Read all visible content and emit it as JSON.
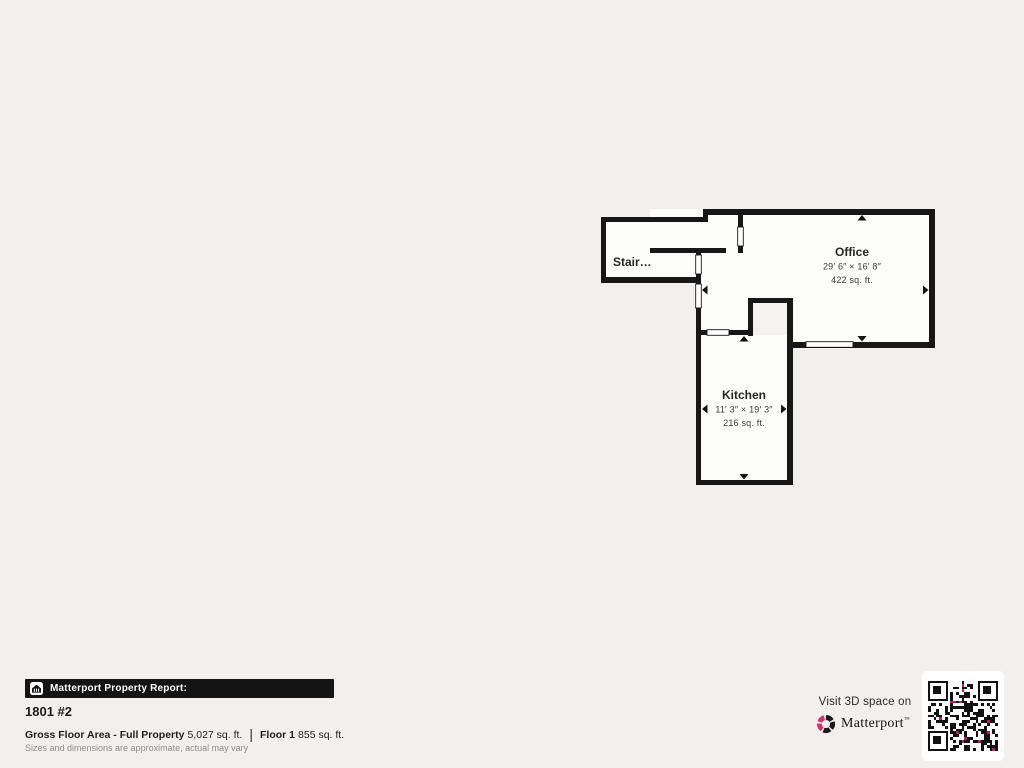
{
  "colors": {
    "page_background": "#f1f0ee",
    "wall": "#171717",
    "room_fill": "#fcfcfb",
    "report_bar_background": "#141414",
    "brand_pink": "#d2356d",
    "qr_accent": "#b22560"
  },
  "floorplan": {
    "rooms": [
      {
        "name": "Stair…"
      },
      {
        "name": "Office",
        "dimensions": "29′ 6″ × 16′ 8″",
        "area": "422 sq. ft."
      },
      {
        "name": "Kitchen",
        "dimensions": "11′ 3″ × 19′ 3″",
        "area": "216 sq. ft."
      }
    ]
  },
  "report": {
    "bar_title": "Matterport Property Report:",
    "unit_title": "1801 #2",
    "gross_label": "Gross Floor Area - Full Property",
    "gross_value": "5,027 sq. ft.",
    "divider": "|",
    "floor_label": "Floor 1",
    "floor_value": "855 sq. ft.",
    "disclaimer": "Sizes and dimensions are approximate, actual may vary"
  },
  "cta": {
    "visit_text": "Visit 3D space on",
    "brand": "Matterport",
    "trademark": "™"
  }
}
